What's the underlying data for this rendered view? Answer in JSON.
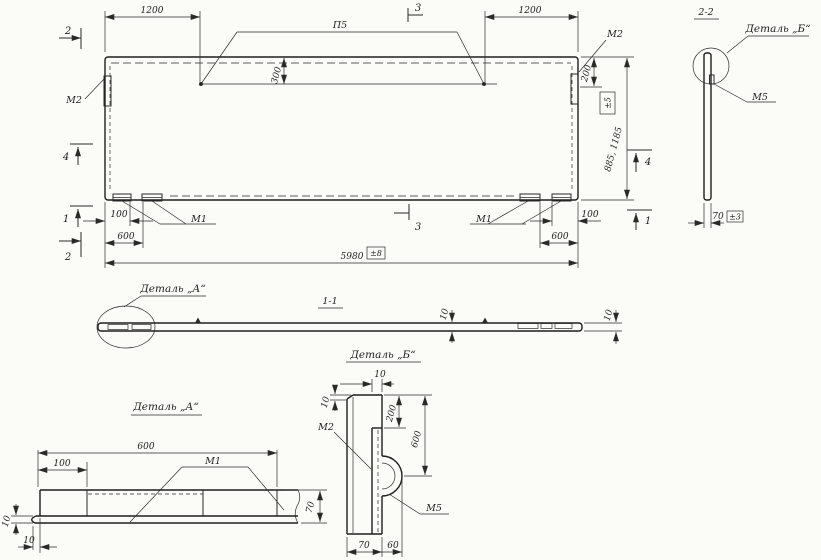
{
  "main_view": {
    "dim_1200_left": "1200",
    "dim_1200_right": "1200",
    "callout_top": "П5",
    "dim_300": "300",
    "dim_200": "200",
    "label_m2_left": "М2",
    "label_m2_right": "М2",
    "label_m1_left": "М1",
    "label_m1_right": "М1",
    "dim_100_left": "100",
    "dim_100_right": "100",
    "dim_600_left": "600",
    "dim_600_right": "600",
    "dim_width": "5980",
    "dim_width_tol": "±8",
    "dim_height": "885, 1185",
    "dim_height_tol": "±5",
    "mark_1": "1",
    "mark_2": "2",
    "mark_3": "3",
    "mark_4": "4"
  },
  "section_2_2": {
    "title": "2-2",
    "detail_callout": "Деталь „Б“",
    "label_m5": "М5",
    "dim_70": "70",
    "dim_70_tol": "±3"
  },
  "section_1_1": {
    "title": "1-1",
    "detail_callout": "Деталь „А“",
    "dim_10_mid": "10",
    "dim_10_end": "10"
  },
  "detail_a": {
    "title": "Деталь „А“",
    "dim_600": "600",
    "dim_100": "100",
    "label_m1": "М1",
    "dim_70": "70",
    "dim_10_thickness": "10",
    "dim_10_offset": "10"
  },
  "detail_b": {
    "title": "Деталь „Б“",
    "dim_10_top": "10",
    "dim_10_side": "10",
    "label_m2": "М2",
    "dim_200": "200",
    "dim_600": "600",
    "dim_70": "70",
    "dim_60": "60",
    "label_m5": "М5"
  }
}
